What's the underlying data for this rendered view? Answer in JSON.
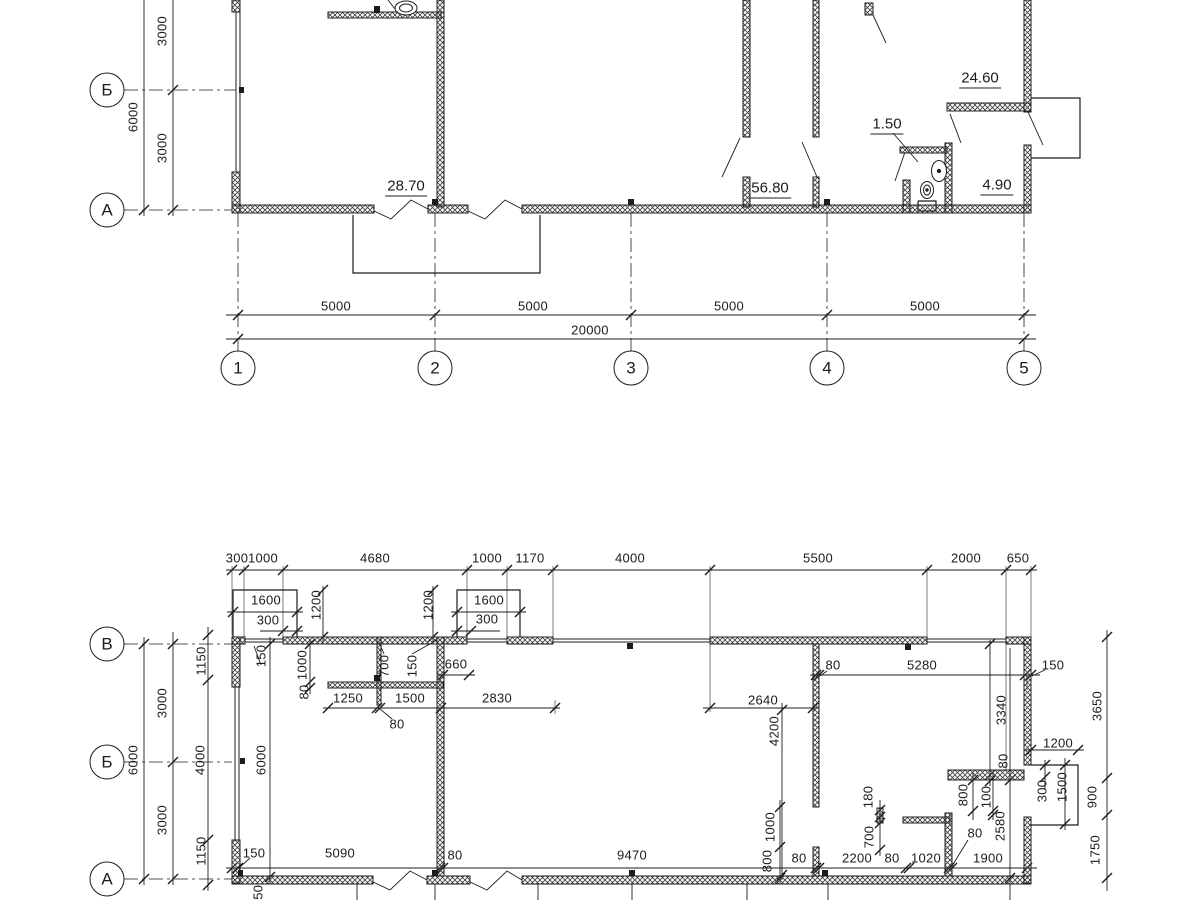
{
  "colors": {
    "ink": "#1c1c1c",
    "background": "#ffffff"
  },
  "upper_plan": {
    "axes_rows": [
      {
        "label": "Б",
        "x": 107,
        "y": 90
      },
      {
        "label": "А",
        "x": 107,
        "y": 210
      }
    ],
    "axes_cols": [
      {
        "label": "1",
        "x": 238,
        "y": 368
      },
      {
        "label": "2",
        "x": 435,
        "y": 368
      },
      {
        "label": "3",
        "x": 631,
        "y": 368
      },
      {
        "label": "4",
        "x": 827,
        "y": 368
      },
      {
        "label": "5",
        "x": 1024,
        "y": 368
      }
    ],
    "room_areas": [
      {
        "text": "28.70",
        "x": 406,
        "y": 187
      },
      {
        "text": "56.80",
        "x": 770,
        "y": 189
      },
      {
        "text": "1.50",
        "x": 887,
        "y": 125
      },
      {
        "text": "24.60",
        "x": 980,
        "y": 79
      },
      {
        "text": "4.90",
        "x": 997,
        "y": 186
      }
    ],
    "dims": [
      {
        "text": "3000",
        "x": 162,
        "y": 31,
        "rot": true
      },
      {
        "text": "6000",
        "x": 133,
        "y": 117,
        "rot": true
      },
      {
        "text": "3000",
        "x": 162,
        "y": 148,
        "rot": true
      },
      {
        "text": "5000",
        "x": 336,
        "y": 306
      },
      {
        "text": "5000",
        "x": 533,
        "y": 306
      },
      {
        "text": "5000",
        "x": 729,
        "y": 306
      },
      {
        "text": "5000",
        "x": 925,
        "y": 306
      },
      {
        "text": "20000",
        "x": 590,
        "y": 330
      }
    ]
  },
  "lower_plan": {
    "axes_rows": [
      {
        "label": "В",
        "x": 107,
        "y": 644
      },
      {
        "label": "Б",
        "x": 107,
        "y": 762
      },
      {
        "label": "А",
        "x": 107,
        "y": 879
      }
    ],
    "dims": [
      {
        "text": "300",
        "x": 237,
        "y": 558
      },
      {
        "text": "1000",
        "x": 263,
        "y": 558
      },
      {
        "text": "4680",
        "x": 375,
        "y": 558
      },
      {
        "text": "1000",
        "x": 487,
        "y": 558
      },
      {
        "text": "1170",
        "x": 530,
        "y": 558
      },
      {
        "text": "4000",
        "x": 630,
        "y": 558
      },
      {
        "text": "5500",
        "x": 818,
        "y": 558
      },
      {
        "text": "2000",
        "x": 966,
        "y": 558
      },
      {
        "text": "650",
        "x": 1018,
        "y": 558
      },
      {
        "text": "1600",
        "x": 266,
        "y": 600
      },
      {
        "text": "300",
        "x": 268,
        "y": 620
      },
      {
        "text": "1200",
        "x": 316,
        "y": 605,
        "rot": true
      },
      {
        "text": "1200",
        "x": 428,
        "y": 605,
        "rot": true
      },
      {
        "text": "1600",
        "x": 489,
        "y": 600
      },
      {
        "text": "300",
        "x": 487,
        "y": 619
      },
      {
        "text": "1150",
        "x": 201,
        "y": 661,
        "rot": true
      },
      {
        "text": "150",
        "x": 261,
        "y": 656,
        "rot": true
      },
      {
        "text": "1000",
        "x": 302,
        "y": 665,
        "rot": true
      },
      {
        "text": "80",
        "x": 304,
        "y": 692,
        "rot": true
      },
      {
        "text": "700",
        "x": 384,
        "y": 666,
        "rot": true
      },
      {
        "text": "150",
        "x": 412,
        "y": 666,
        "rot": true
      },
      {
        "text": "660",
        "x": 456,
        "y": 664
      },
      {
        "text": "1250",
        "x": 348,
        "y": 698
      },
      {
        "text": "1500",
        "x": 410,
        "y": 698
      },
      {
        "text": "80",
        "x": 397,
        "y": 724
      },
      {
        "text": "2830",
        "x": 497,
        "y": 698
      },
      {
        "text": "3000",
        "x": 162,
        "y": 703,
        "rot": true
      },
      {
        "text": "6000",
        "x": 133,
        "y": 760,
        "rot": true
      },
      {
        "text": "6000",
        "x": 261,
        "y": 760,
        "rot": true
      },
      {
        "text": "4000",
        "x": 200,
        "y": 760,
        "rot": true
      },
      {
        "text": "3000",
        "x": 162,
        "y": 820,
        "rot": true
      },
      {
        "text": "1150",
        "x": 201,
        "y": 851,
        "rot": true
      },
      {
        "text": "2640",
        "x": 763,
        "y": 700
      },
      {
        "text": "4200",
        "x": 774,
        "y": 731,
        "rot": true
      },
      {
        "text": "80",
        "x": 833,
        "y": 665
      },
      {
        "text": "5280",
        "x": 922,
        "y": 665
      },
      {
        "text": "150",
        "x": 1053,
        "y": 665
      },
      {
        "text": "3340",
        "x": 1001,
        "y": 710,
        "rot": true
      },
      {
        "text": "80",
        "x": 1003,
        "y": 761,
        "rot": true
      },
      {
        "text": "3650",
        "x": 1097,
        "y": 706,
        "rot": true
      },
      {
        "text": "1200",
        "x": 1058,
        "y": 743
      },
      {
        "text": "300",
        "x": 1042,
        "y": 791,
        "rot": true
      },
      {
        "text": "1500",
        "x": 1062,
        "y": 787,
        "rot": true
      },
      {
        "text": "900",
        "x": 1092,
        "y": 797,
        "rot": true
      },
      {
        "text": "1750",
        "x": 1095,
        "y": 850,
        "rot": true
      },
      {
        "text": "180",
        "x": 868,
        "y": 797,
        "rot": true
      },
      {
        "text": "700",
        "x": 869,
        "y": 837,
        "rot": true
      },
      {
        "text": "800",
        "x": 963,
        "y": 795,
        "rot": true
      },
      {
        "text": "100",
        "x": 986,
        "y": 797,
        "rot": true
      },
      {
        "text": "2580",
        "x": 1000,
        "y": 826,
        "rot": true
      },
      {
        "text": "1000",
        "x": 770,
        "y": 827,
        "rot": true
      },
      {
        "text": "800",
        "x": 767,
        "y": 861,
        "rot": true
      },
      {
        "text": "150",
        "x": 254,
        "y": 853
      },
      {
        "text": "5090",
        "x": 340,
        "y": 853
      },
      {
        "text": "80",
        "x": 455,
        "y": 855
      },
      {
        "text": "9470",
        "x": 632,
        "y": 855
      },
      {
        "text": "80",
        "x": 799,
        "y": 858
      },
      {
        "text": "2200",
        "x": 857,
        "y": 858
      },
      {
        "text": "80",
        "x": 892,
        "y": 858
      },
      {
        "text": "1020",
        "x": 926,
        "y": 858
      },
      {
        "text": "80",
        "x": 975,
        "y": 833
      },
      {
        "text": "1900",
        "x": 988,
        "y": 858
      },
      {
        "text": "150",
        "x": 258,
        "y": 896,
        "rot": true
      }
    ]
  }
}
